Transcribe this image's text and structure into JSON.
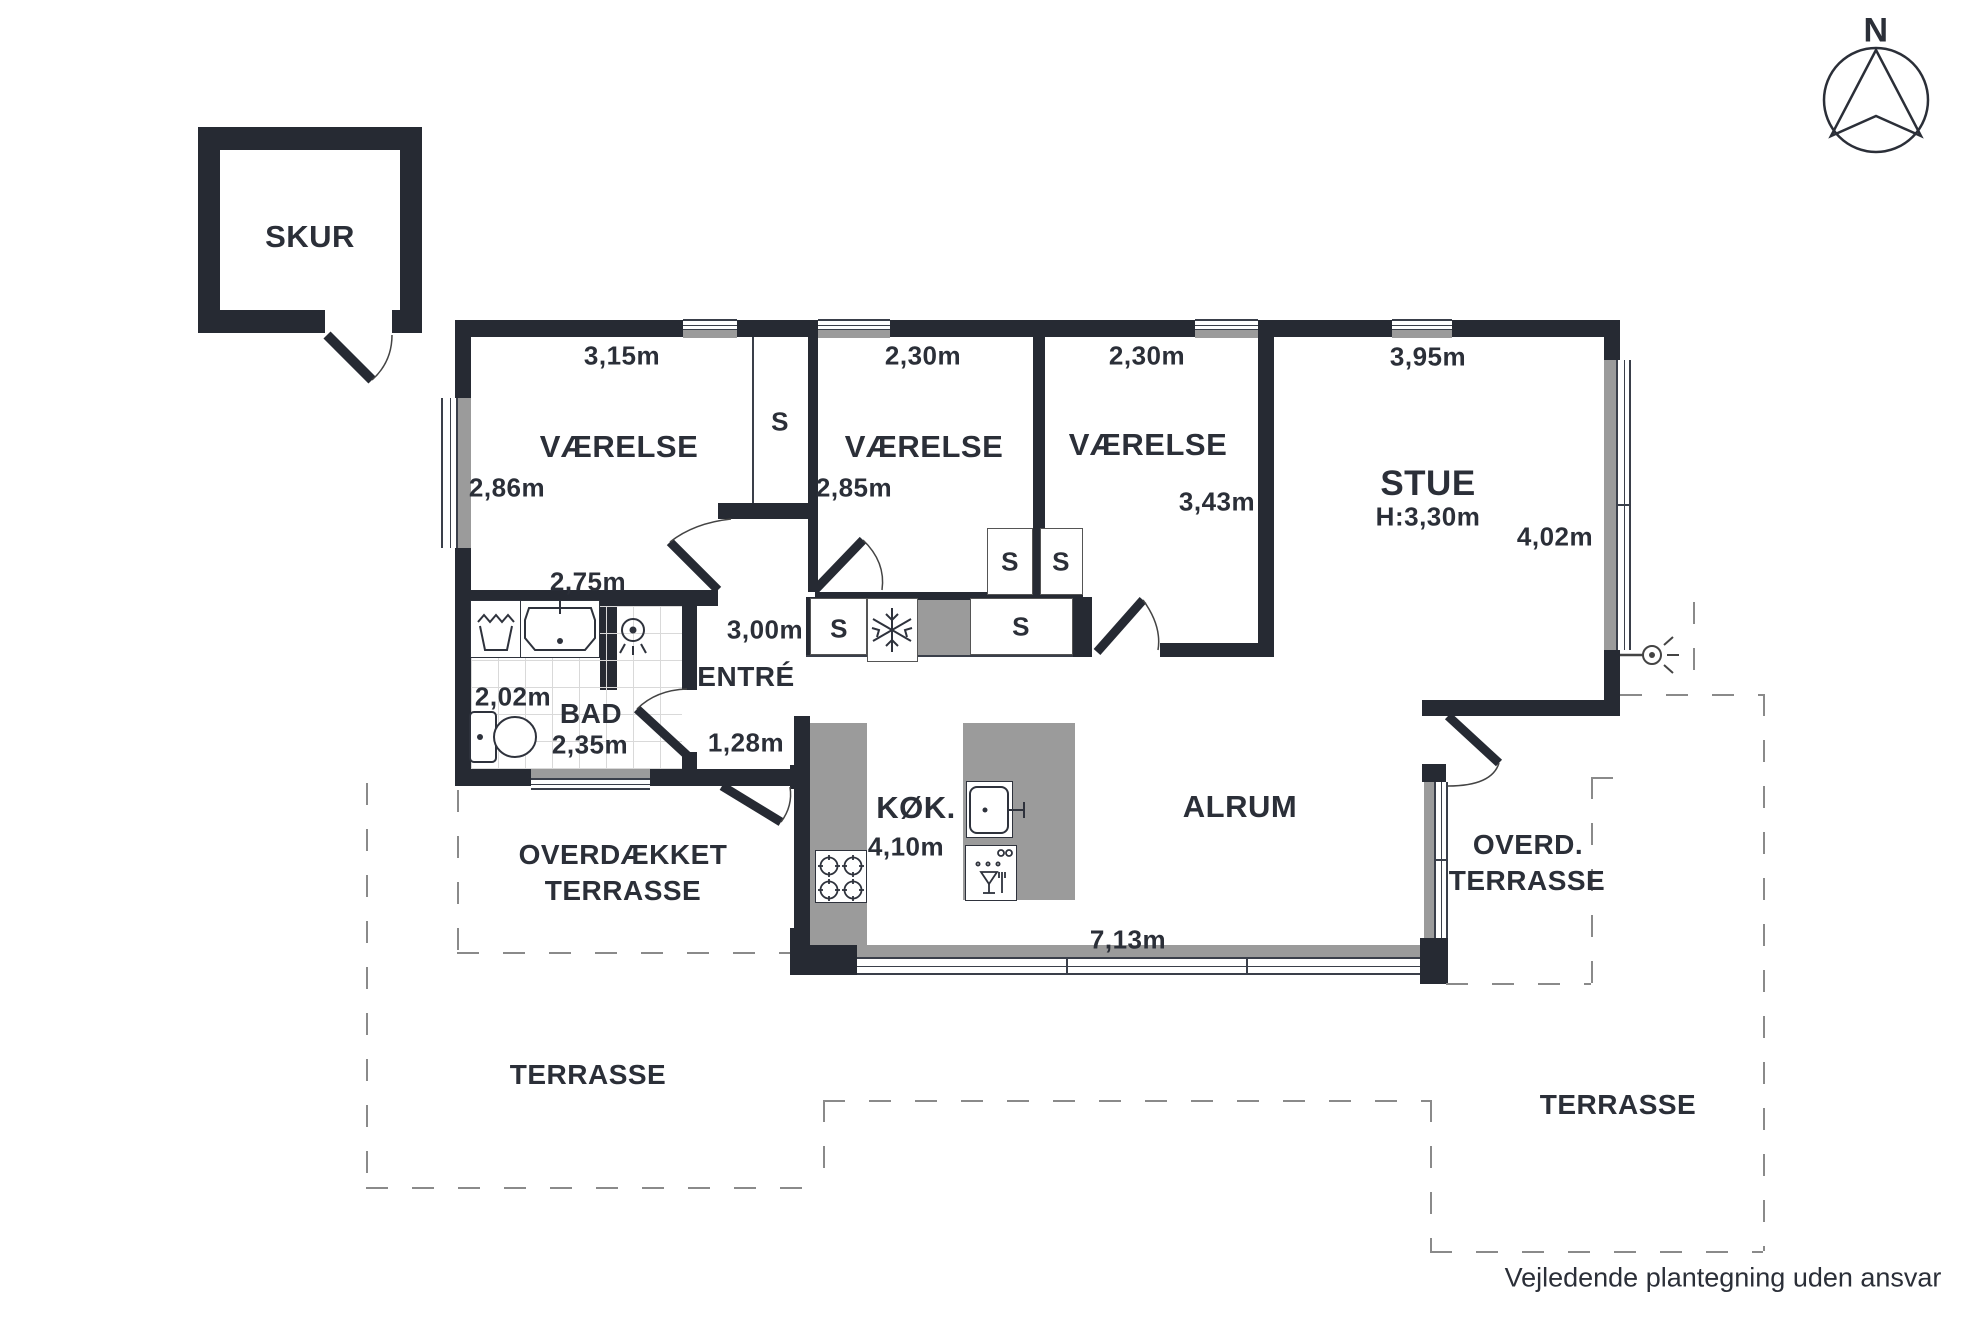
{
  "shed": {
    "label": "SKUR"
  },
  "compass": {
    "label": "N"
  },
  "rooms": {
    "vaerelse1": {
      "label": "VÆRELSE",
      "top": "3,15m",
      "left": "2,86m",
      "bottom": "2,75m"
    },
    "vaerelse2": {
      "label": "VÆRELSE",
      "top": "2,30m",
      "left": "2,85m"
    },
    "vaerelse3": {
      "label": "VÆRELSE",
      "top": "2,30m",
      "right": "3,43m"
    },
    "stue": {
      "label": "STUE",
      "height": "H:3,30m",
      "top": "3,95m",
      "right": "4,02m"
    },
    "bad": {
      "label": "BAD",
      "left": "2,02m",
      "bottom": "2,35m"
    },
    "entre": {
      "label": "ENTRÉ",
      "top": "3,00m",
      "bottom": "1,28m"
    },
    "kok": {
      "label": "KØK.",
      "dim": "4,10m"
    },
    "alrum": {
      "label": "ALRUM",
      "bottom": "7,13m"
    }
  },
  "closet_label": "S",
  "terraces": {
    "overdaekket": [
      "OVERDÆKKET",
      "TERRASSE"
    ],
    "terrasse_left": "TERRASSE",
    "overd": [
      "OVERD.",
      "TERRASSE"
    ],
    "terrasse_right": "TERRASSE"
  },
  "footer": {
    "disclaimer": "Vejledende plantegning uden ansvar"
  },
  "colors": {
    "wall": "#262a33",
    "fixture_gray": "#9b9b9b",
    "dash": "#8a8a8a"
  }
}
